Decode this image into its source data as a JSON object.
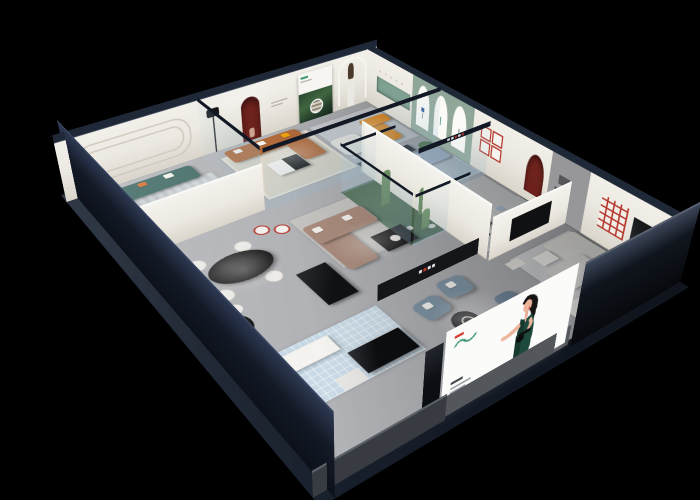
{
  "scene": {
    "type": "3d-cutaway-showroom-render",
    "background": "#000000"
  },
  "palette": {
    "bg": "#000000",
    "outer_wall": "#1f2836",
    "outer_wall_deep": "#0c111a",
    "wall_cream": "#ece9e2",
    "wall_cream_dark": "#d9d5cb",
    "wall_green": "#8fa698",
    "glass_frame": "#121824",
    "niche_red": "#6e221d",
    "accent_red": "#b5372c",
    "accent_orange": "#e8860f",
    "pillow_yellow": "#f0a50a",
    "sofa_caramel": "#b26a3a",
    "sofa_teal": "#4e746f",
    "sofa_taupe": "#ab8d7e",
    "sofa_bluegray": "#7e93a3",
    "sofa_lightblue": "#a9bed6",
    "sofa_sage": "#9cb3a5",
    "sofa_gray": "#bcbfc1",
    "sofa_white": "#e3e2de",
    "leather_brown": "#96582f",
    "table_black": "#141414",
    "floor_light": "#b1b2b5",
    "floor_mid": "#a2a4a8",
    "rug_cream": "#dcd5c6",
    "rug_stripe_a": "#ced3d6",
    "rug_stripe_b": "#c0c6ca",
    "rug_blue": "#b6c6d4",
    "rug_gray": "#c3c5c7",
    "tile_blue": "#c9dae6",
    "atrium_green": "#4e6b52",
    "cactus": "#5c7d55",
    "plant": "#3f6b42",
    "billboard_white": "#fbfbf9",
    "dress_green": "#1d4a3c",
    "logo_green": "#2f9469",
    "logo_red": "#d03a2e",
    "skin": "#ecb49b",
    "cut_gray": "#53575c",
    "sign_dark": "#14161a"
  }
}
